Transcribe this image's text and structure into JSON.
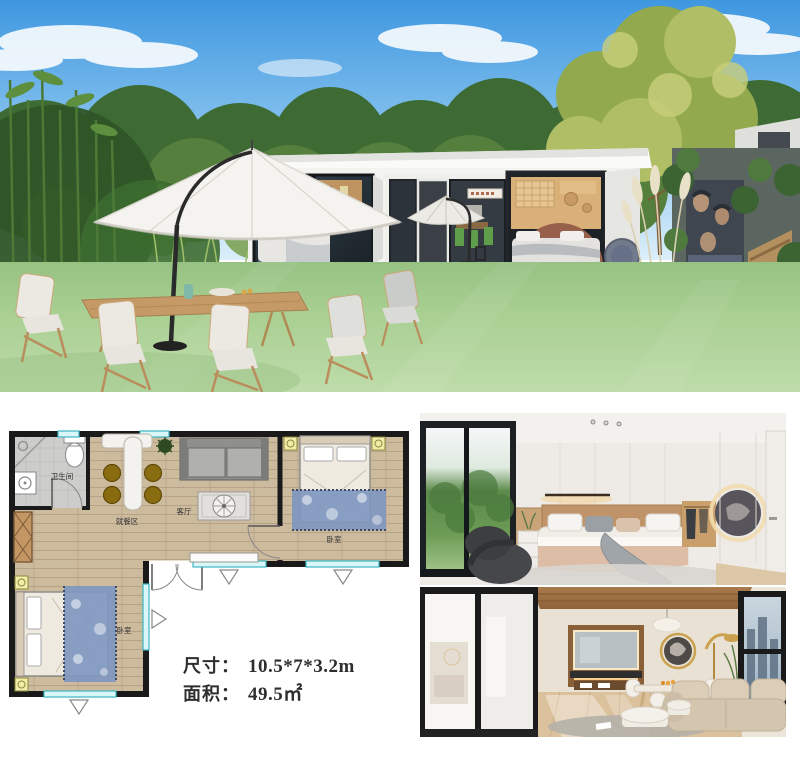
{
  "specs": {
    "size_label": "尺寸：",
    "size_value": "10.5*7*3.2m",
    "area_label": "面积：",
    "area_value": "49.5㎡"
  },
  "floor_plan": {
    "labels": {
      "bathroom": "卫生间",
      "dining": "就餐区",
      "living": "客厅",
      "bedroom_right": "卧室",
      "bedroom_left": "卧室"
    }
  },
  "palette": {
    "sky": "#5ba6e4",
    "grass": "#a9cf92",
    "house_wall": "#f3f3f0",
    "window_marker": "#3fb6c4",
    "plan_wall": "#1a1a1a",
    "wood_floor": "#cdbb9e",
    "rug_blue": "#7f97c0",
    "stool_brown": "#8a6c10",
    "text": "#2e2e2e"
  }
}
